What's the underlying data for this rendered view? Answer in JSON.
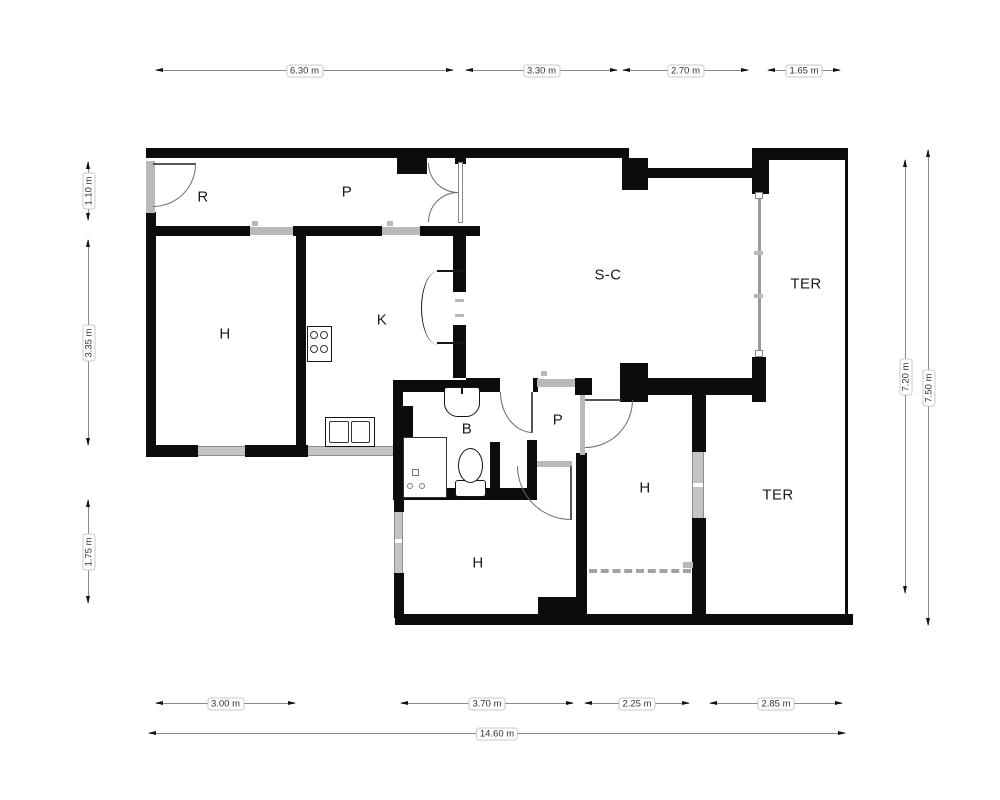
{
  "floor_plan": {
    "room_labels": [
      {
        "id": "hall-r",
        "label": "R"
      },
      {
        "id": "corridor-p",
        "label": "P"
      },
      {
        "id": "bedroom-h1",
        "label": "H"
      },
      {
        "id": "kitchen-k",
        "label": "K"
      },
      {
        "id": "living-sc",
        "label": "S-C"
      },
      {
        "id": "terrace-1",
        "label": "TER"
      },
      {
        "id": "bathroom-b",
        "label": "B"
      },
      {
        "id": "hall-p2",
        "label": "P"
      },
      {
        "id": "bedroom-h2",
        "label": "H"
      },
      {
        "id": "bedroom-h3",
        "label": "H"
      },
      {
        "id": "terrace-2",
        "label": "TER"
      }
    ],
    "dimensions": {
      "top": [
        {
          "label": "6.30 m"
        },
        {
          "label": "3.30 m"
        },
        {
          "label": "2.70 m"
        },
        {
          "label": "1.65 m"
        }
      ],
      "bottom": [
        {
          "label": "3.00 m"
        },
        {
          "label": "3.70 m"
        },
        {
          "label": "2.25 m"
        },
        {
          "label": "2.85 m"
        }
      ],
      "bottom_total": {
        "label": "14.60 m"
      },
      "left": [
        {
          "label": "1.10 m"
        },
        {
          "label": "3.35 m"
        },
        {
          "label": "1.75 m"
        }
      ],
      "right": [
        {
          "label": "7.20 m"
        },
        {
          "label": "7.50 m"
        }
      ]
    },
    "colors": {
      "wall": "#0c0c0c",
      "window": "#b9b9b9",
      "dim_line": "#8a8a8a"
    }
  }
}
